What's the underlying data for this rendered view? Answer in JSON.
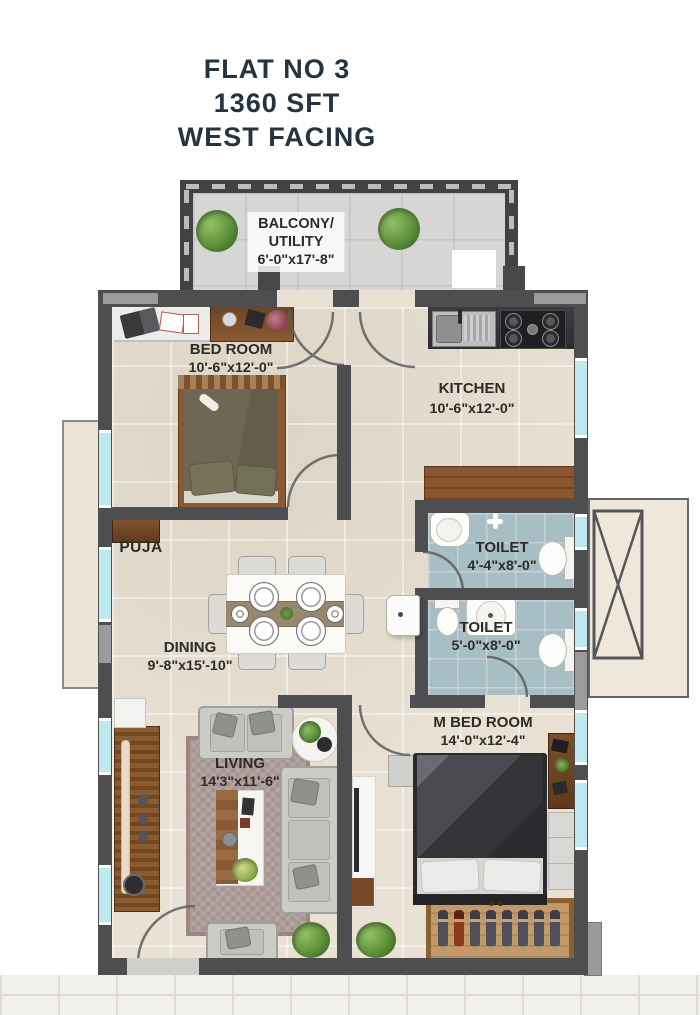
{
  "title": {
    "lines": [
      "FLAT NO 3",
      "1360 SFT",
      "WEST FACING"
    ]
  },
  "rooms": {
    "balcony": {
      "label_line1": "BALCONY/",
      "label_line2": "UTILITY",
      "dims": "6'-0\"x17'-8\""
    },
    "bedroom": {
      "label": "BED ROOM",
      "dims": "10'-6\"x12'-0\""
    },
    "kitchen": {
      "label": "KITCHEN",
      "dims": "10'-6\"x12'-0\""
    },
    "toilet_top": {
      "label": "TOILET",
      "dims": "4'-4\"x8'-0\""
    },
    "toilet_bottom": {
      "label": "TOILET",
      "dims": "5'-0\"x8'-0\""
    },
    "puja": {
      "label": "PUJA"
    },
    "dining": {
      "label": "DINING",
      "dims": "9'-8\"x15'-10\""
    },
    "living": {
      "label": "LIVING",
      "dims": "14'3\"x11'-6\""
    },
    "master_bedroom": {
      "label": "M BED ROOM",
      "dims": "14'-0\"x12'-4\""
    }
  },
  "colors": {
    "title_text": "#263440",
    "label_text": "#2d2b27",
    "wall": "#4e4e50",
    "wall_light": "#9b9b9d",
    "window": "#bce8ee",
    "floor": "#e8e1d4",
    "toilet_floor": "#a7bec4",
    "wood": "#7c4c28",
    "balcony_floor": "#d6d6d4"
  }
}
